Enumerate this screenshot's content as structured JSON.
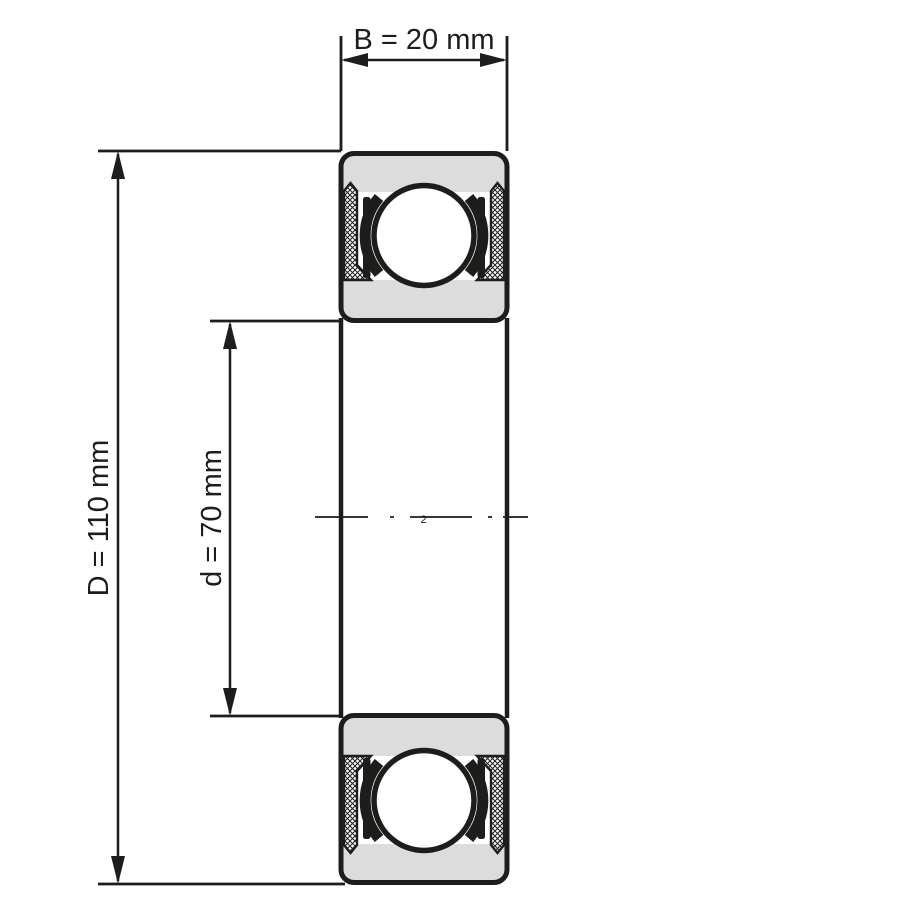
{
  "drawing": {
    "type": "deep-groove-ball-bearing-cross-section",
    "dimensions": {
      "width": {
        "label": "B = 20 mm",
        "value_mm": 20
      },
      "outer_diameter": {
        "label": "D = 110 mm",
        "value_mm": 110
      },
      "bore_diameter": {
        "label": "d = 70 mm",
        "value_mm": 70
      }
    },
    "centerline_mark": "2",
    "colors": {
      "line": "#1d1d1b",
      "ring_fill": "#dcdcdc",
      "ball_fill": "#ffffff",
      "background": "#ffffff"
    }
  }
}
